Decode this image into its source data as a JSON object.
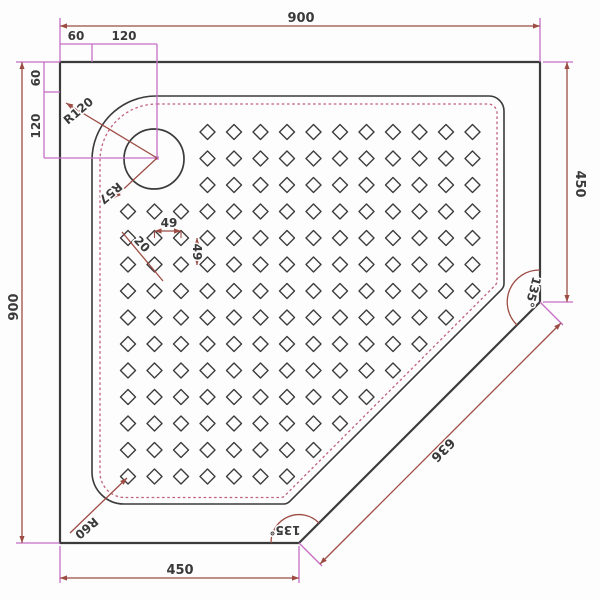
{
  "drawing": {
    "title": "corner shower tray plan view",
    "labels": {
      "top_width": "900",
      "left_height": "900",
      "right_height": "450",
      "bottom_width": "450",
      "diagonal_length": "636",
      "top_angle": "135°",
      "bottom_angle": "135°",
      "corner_radius": "R120",
      "drain_radius": "R57",
      "inner_corner_radius": "R60",
      "drain_offset_top_1": "60",
      "drain_offset_top_2": "120",
      "drain_offset_left_1": "60",
      "drain_offset_left_2": "120",
      "pattern_pitch_h": "49",
      "pattern_pitch_v": "49",
      "pattern_size": "20"
    },
    "pattern": {
      "cols": 14,
      "rows": 14,
      "origin_x": 128,
      "origin_y": 132,
      "step": 26.5,
      "half_diagonal": 7.5,
      "skip_block": 3,
      "diag_limit": 778
    },
    "colors": {
      "outline": "#3b3b3b",
      "dimension": "#9d4c44",
      "extension": "#c66ec6",
      "dashed": "#c2607c",
      "text": "#3a3a3a",
      "background": "#fdfdfd"
    }
  }
}
